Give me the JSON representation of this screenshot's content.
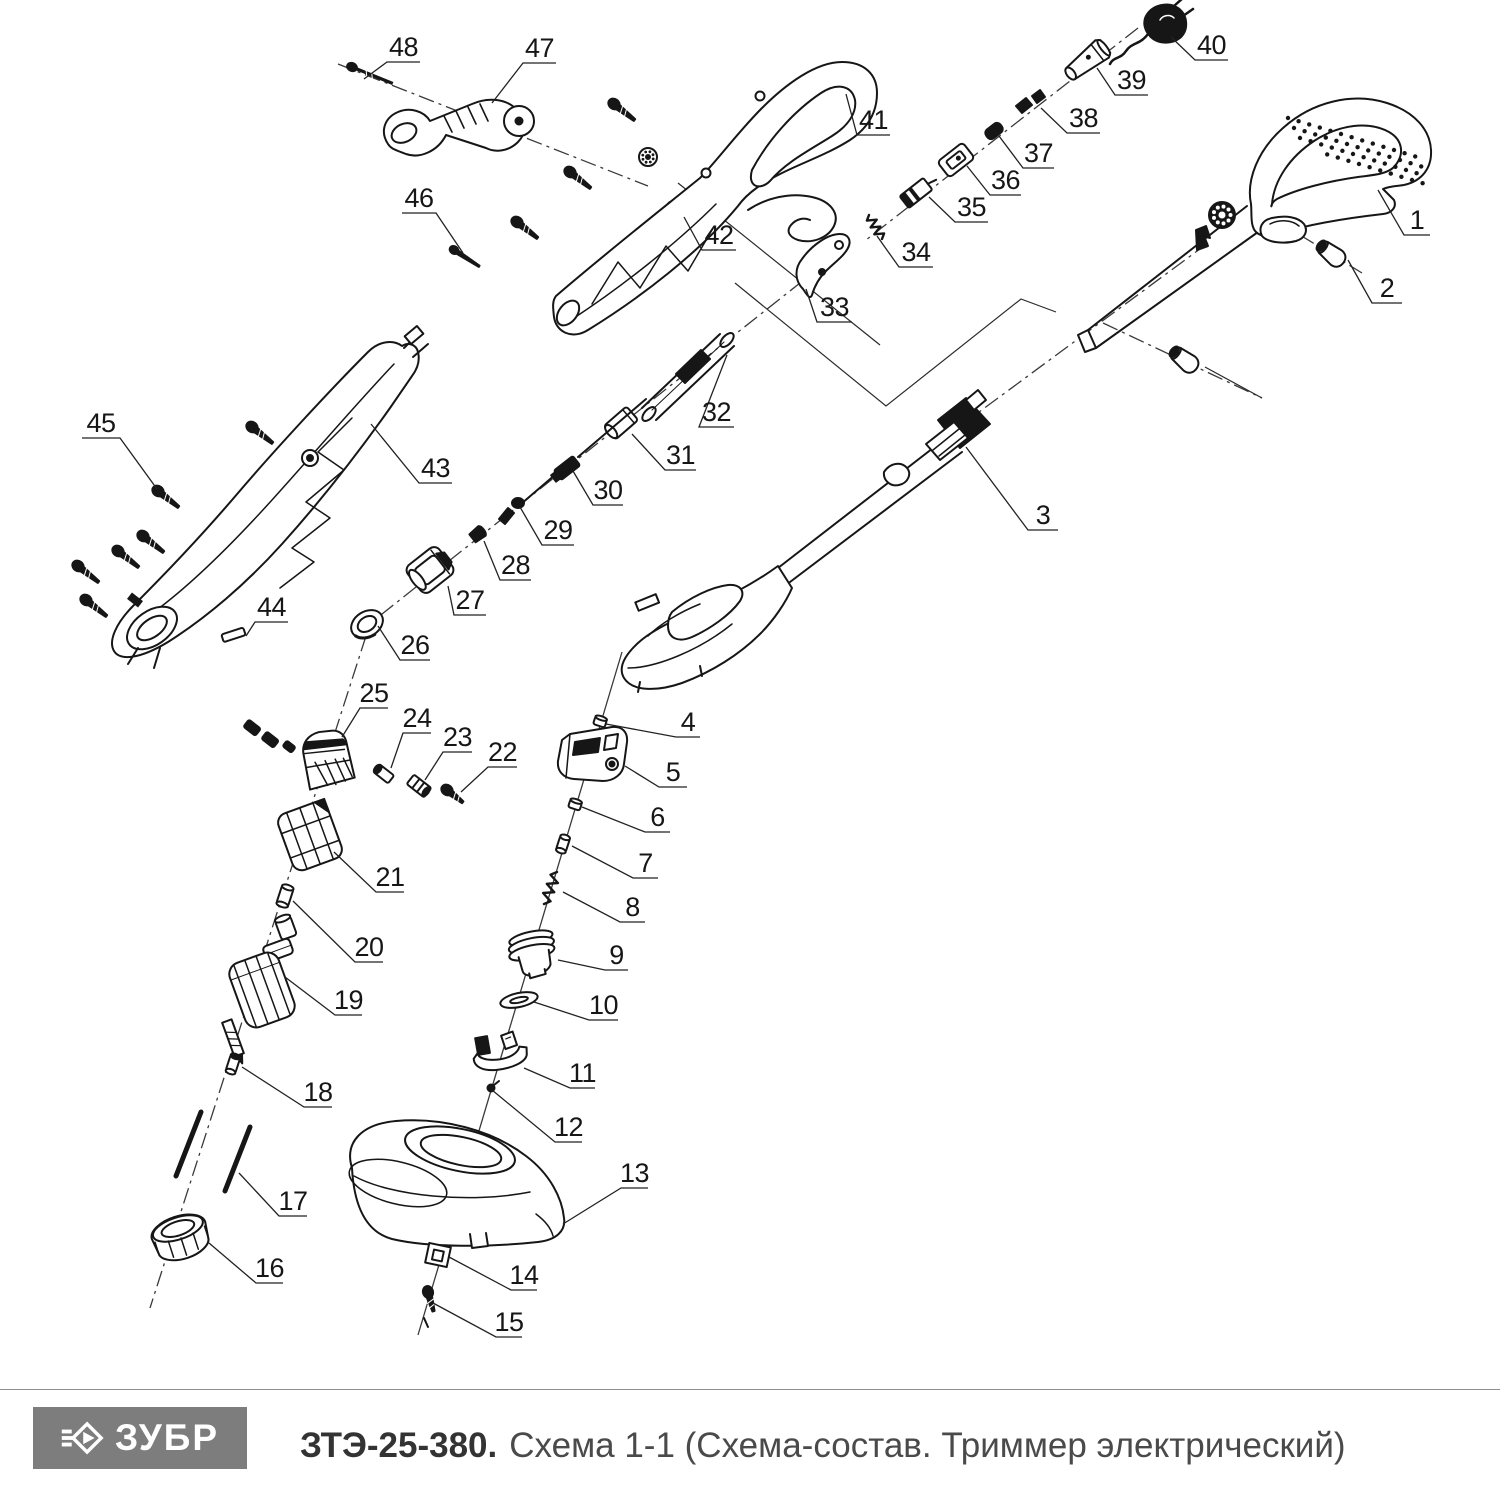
{
  "footer": {
    "logo_text": "ЗУБР",
    "model": "ЗТЭ-25-380.",
    "subtitle": "Схема 1-1 (Схема-состав. Триммер электрический)"
  },
  "diagram": {
    "callouts": [
      {
        "n": "1",
        "u": [
          1404,
          1430,
          235
        ],
        "p": [
          1378,
          190
        ]
      },
      {
        "n": "2",
        "u": [
          1372,
          1402,
          303
        ],
        "p": [
          1348,
          260
        ]
      },
      {
        "n": "3",
        "u": [
          1028,
          1058,
          530
        ],
        "p": [
          966,
          447
        ]
      },
      {
        "n": "4",
        "u": [
          676,
          700,
          737
        ],
        "p": [
          606,
          724
        ]
      },
      {
        "n": "5",
        "u": [
          659,
          687,
          787
        ],
        "p": [
          625,
          766
        ]
      },
      {
        "n": "6",
        "u": [
          645,
          670,
          832
        ],
        "p": [
          582,
          807
        ]
      },
      {
        "n": "7",
        "u": [
          633,
          658,
          878
        ],
        "p": [
          572,
          846
        ]
      },
      {
        "n": "8",
        "u": [
          620,
          645,
          922
        ],
        "p": [
          563,
          892
        ]
      },
      {
        "n": "9",
        "u": [
          605,
          628,
          970
        ],
        "p": [
          558,
          960
        ]
      },
      {
        "n": "10",
        "u": [
          589,
          618,
          1020
        ],
        "p": [
          534,
          1002
        ]
      },
      {
        "n": "11",
        "u": [
          570,
          595,
          1088
        ],
        "p": [
          524,
          1068
        ]
      },
      {
        "n": "12",
        "u": [
          555,
          582,
          1142
        ],
        "p": [
          492,
          1090
        ]
      },
      {
        "n": "13",
        "u": [
          621,
          648,
          1188
        ],
        "p": [
          563,
          1224
        ]
      },
      {
        "n": "14",
        "u": [
          511,
          537,
          1290
        ],
        "p": [
          449,
          1257
        ]
      },
      {
        "n": "15",
        "u": [
          496,
          522,
          1337
        ],
        "p": [
          433,
          1303
        ]
      },
      {
        "n": "16",
        "u": [
          256,
          283,
          1283
        ],
        "p": [
          209,
          1243
        ]
      },
      {
        "n": "17",
        "u": [
          279,
          307,
          1216
        ],
        "p": [
          239,
          1173
        ]
      },
      {
        "n": "18",
        "u": [
          304,
          332,
          1107
        ],
        "p": [
          242,
          1067
        ]
      },
      {
        "n": "19",
        "u": [
          335,
          362,
          1015
        ],
        "p": [
          285,
          977
        ]
      },
      {
        "n": "20",
        "u": [
          355,
          383,
          962
        ],
        "p": [
          293,
          901
        ]
      },
      {
        "n": "21",
        "u": [
          376,
          404,
          892
        ],
        "p": [
          334,
          852
        ]
      },
      {
        "n": "22",
        "u": [
          488,
          517,
          767
        ],
        "p": [
          461,
          792
        ]
      },
      {
        "n": "23",
        "u": [
          443,
          472,
          752
        ],
        "p": [
          425,
          780
        ]
      },
      {
        "n": "24",
        "u": [
          403,
          431,
          733
        ],
        "p": [
          391,
          768
        ]
      },
      {
        "n": "25",
        "u": [
          360,
          388,
          708
        ],
        "p": [
          342,
          737
        ]
      },
      {
        "n": "26",
        "u": [
          400,
          430,
          660
        ],
        "p": [
          378,
          626
        ]
      },
      {
        "n": "27",
        "u": [
          454,
          486,
          615
        ],
        "p": [
          448,
          586
        ]
      },
      {
        "n": "28",
        "u": [
          500,
          531,
          580
        ],
        "p": [
          484,
          541
        ]
      },
      {
        "n": "29",
        "u": [
          542,
          574,
          545
        ],
        "p": [
          520,
          507
        ]
      },
      {
        "n": "30",
        "u": [
          593,
          623,
          505
        ],
        "p": [
          573,
          471
        ]
      },
      {
        "n": "31",
        "u": [
          665,
          696,
          470
        ],
        "p": [
          632,
          434
        ]
      },
      {
        "n": "32",
        "u": [
          699,
          734,
          427
        ],
        "p": [
          727,
          355
        ]
      },
      {
        "n": "33",
        "u": [
          817,
          852,
          322
        ],
        "p": [
          806,
          289
        ]
      },
      {
        "n": "34",
        "u": [
          899,
          933,
          267
        ],
        "p": [
          877,
          236
        ]
      },
      {
        "n": "35",
        "u": [
          955,
          988,
          222
        ],
        "p": [
          929,
          197
        ]
      },
      {
        "n": "36",
        "u": [
          990,
          1021,
          195
        ],
        "p": [
          967,
          166
        ]
      },
      {
        "n": "37",
        "u": [
          1023,
          1054,
          168
        ],
        "p": [
          999,
          136
        ]
      },
      {
        "n": "38",
        "u": [
          1067,
          1100,
          133
        ],
        "p": [
          1041,
          108
        ]
      },
      {
        "n": "39",
        "u": [
          1115,
          1148,
          95
        ],
        "p": [
          1097,
          68
        ]
      },
      {
        "n": "40",
        "u": [
          1195,
          1228,
          60
        ],
        "p": [
          1171,
          37
        ]
      },
      {
        "n": "41",
        "u": [
          857,
          890,
          135
        ],
        "p": [
          846,
          94
        ]
      },
      {
        "n": "42",
        "u": [
          702,
          736,
          250
        ],
        "p": [
          684,
          217
        ]
      },
      {
        "n": "43",
        "u": [
          419,
          452,
          483
        ],
        "p": [
          371,
          424
        ]
      },
      {
        "n": "44",
        "u": [
          255,
          288,
          622
        ],
        "p": [
          246,
          636
        ]
      },
      {
        "n": "45",
        "u": [
          82,
          120,
          438
        ],
        "p": [
          157,
          489
        ]
      },
      {
        "n": "46",
        "u": [
          402,
          436,
          213
        ],
        "p": [
          463,
          253
        ]
      },
      {
        "n": "47",
        "u": [
          523,
          556,
          63
        ],
        "p": [
          492,
          103
        ]
      },
      {
        "n": "48",
        "u": [
          387,
          420,
          62
        ],
        "p": [
          364,
          79
        ]
      }
    ],
    "axes": [
      {
        "style": "dashdot",
        "pts": [
          [
            338,
            64
          ],
          [
            648,
            186
          ]
        ]
      },
      {
        "style": "dashdot",
        "pts": [
          [
            1138,
            28
          ],
          [
            866,
            240
          ]
        ]
      },
      {
        "style": "dashdot",
        "pts": [
          [
            848,
            245
          ],
          [
            358,
            633
          ]
        ]
      },
      {
        "style": "dashdot",
        "pts": [
          [
            366,
            636
          ],
          [
            150,
            1308
          ]
        ]
      },
      {
        "style": "solid",
        "pts": [
          [
            622,
            652
          ],
          [
            418,
            1335
          ]
        ]
      },
      {
        "style": "dashdot",
        "pts": [
          [
            1208,
            243
          ],
          [
            952,
            432
          ]
        ]
      },
      {
        "style": "dashdot",
        "pts": [
          [
            1300,
            235
          ],
          [
            1362,
            273
          ]
        ]
      },
      {
        "style": "dashdot",
        "pts": [
          [
            1103,
            323
          ],
          [
            1262,
            398
          ]
        ]
      }
    ],
    "links": [
      [
        [
          678,
          183
        ],
        [
          880,
          345
        ]
      ],
      [
        [
          735,
          283
        ],
        [
          886,
          406
        ],
        [
          1021,
          299
        ],
        [
          1056,
          312
        ]
      ],
      [
        [
          1205,
          367
        ],
        [
          1262,
          398
        ]
      ]
    ]
  }
}
